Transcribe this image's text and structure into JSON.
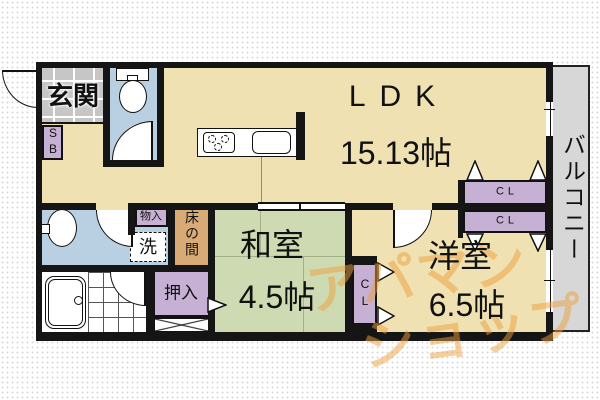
{
  "plan_title": "apartment floor plan",
  "rooms": {
    "genkan": {
      "label": "玄関"
    },
    "ldk": {
      "label": "LDK",
      "size": "15.13帖"
    },
    "washitsu": {
      "label": "和室",
      "size": "4.5帖"
    },
    "youshitsu": {
      "label": "洋室",
      "size": "6.5帖"
    },
    "balcony": {
      "label": "バルコニー"
    },
    "tokonoma": {
      "label": "床の間"
    },
    "oshiire": {
      "label": "押入"
    },
    "monoire": {
      "label": "物入"
    },
    "laundry": {
      "label": "洗"
    },
    "shoe_box": {
      "label": "SB"
    },
    "closet_upper": {
      "label": "CL"
    },
    "closet_lower": {
      "label": "CL"
    },
    "closet_side": {
      "label": "CL"
    }
  },
  "watermark": {
    "line1": "アパマン",
    "line2": "ショップ"
  },
  "colors": {
    "floor_tan": "#f0e1b2",
    "tatami_green": "#cedbb2",
    "closet_purple": "#c6b1d4",
    "water_blue": "#b9d0e2",
    "tile_gray": "#c6c6c6",
    "tokonoma_brown": "#d8ab76",
    "balcony_gray": "#d7d7d7",
    "wall_black": "#151515",
    "watermark_orange": "#eca03c"
  }
}
